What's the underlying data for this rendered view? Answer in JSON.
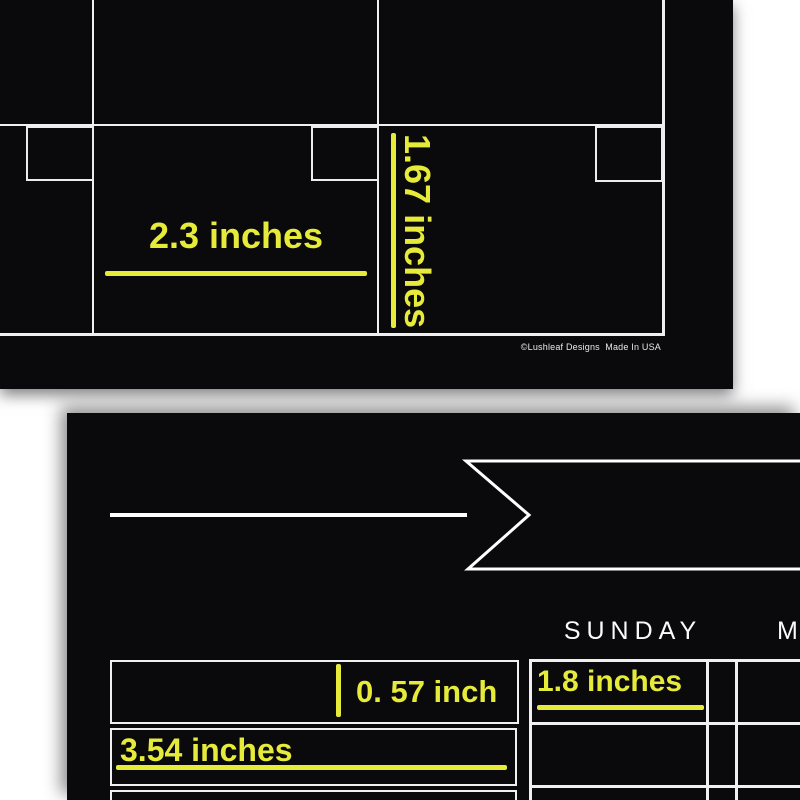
{
  "colors": {
    "board_black": "#0a0a0c",
    "grid_line_white": "#f0f0f0",
    "accent_yellow": "#e6eb3a",
    "text_white": "#fafafa"
  },
  "top_board": {
    "width_label": "2.3 inches",
    "height_label": "1.67 inches",
    "copyright": "©Lushleaf Designs  Made In USA"
  },
  "bottom_board": {
    "day_label_sunday": "SUNDAY",
    "day_label_monday_partial": "M",
    "row_height_label": "0. 57 inch",
    "notes_width_label": "3.54 inches",
    "column_width_label": "1.8 inches"
  }
}
